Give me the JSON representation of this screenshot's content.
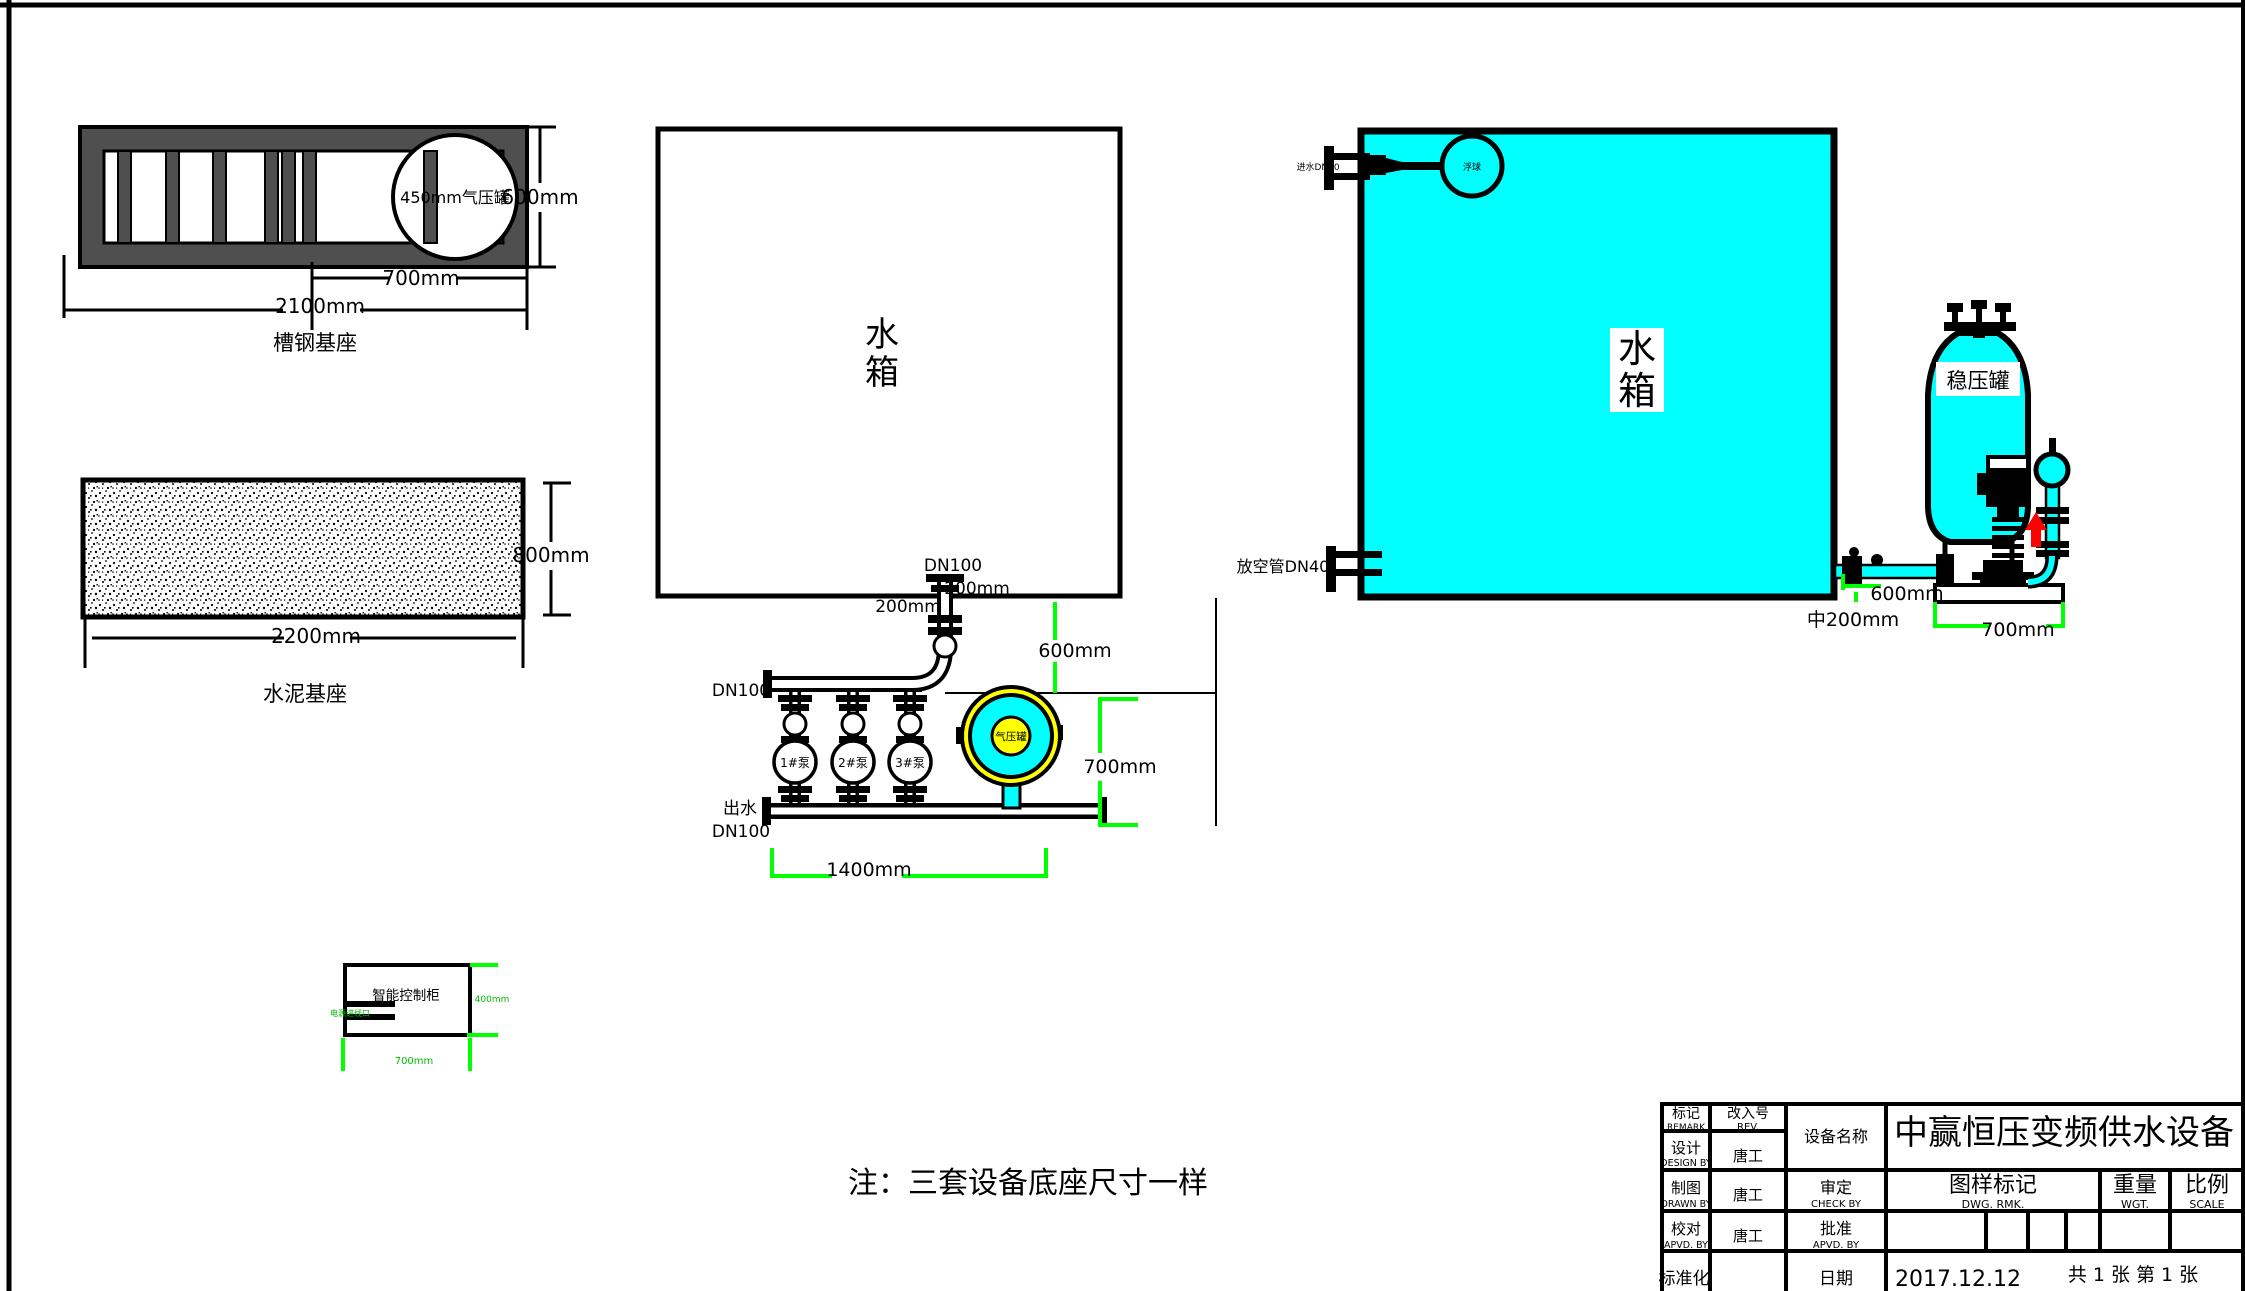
{
  "colors": {
    "cyan": "#00FFFF",
    "yellow": "#FFFF00",
    "dim_green": "#00FF00",
    "arrow_red": "#FF0000",
    "steel_gray": "#4F4F4F",
    "line_black": "#000000"
  },
  "steel_base": {
    "label": "槽钢基座",
    "tank_circle_label": "450mm气压罐",
    "dim_total_width": "2100mm",
    "dim_right_width": "700mm",
    "dim_height": "600mm"
  },
  "cement_base": {
    "label": "水泥基座",
    "dim_width": "2200mm",
    "dim_height": "800mm"
  },
  "plan_view": {
    "tank_char_top": "水",
    "tank_char_bottom": "箱",
    "inlet_dn": "DN100",
    "offset_right": "200mm",
    "offset_left": "200mm",
    "manifold_dn": "DN100",
    "outlet_label": "出水",
    "outlet_dn": "DN100",
    "pumps": [
      "1#泵",
      "2#泵",
      "3#泵"
    ],
    "pressure_tank_label": "气压罐",
    "dim_gap": "600mm",
    "dim_depth": "700mm",
    "dim_width": "1400mm"
  },
  "elevation_view": {
    "tank_char_top": "水",
    "tank_char_bottom": "箱",
    "inlet_label": "进水DN50",
    "float_label": "浮球",
    "drain_label": "放空管DN40",
    "stab_tank_label": "稳压罐",
    "dim_gap": "600mm",
    "dim_offset": "中200mm",
    "dim_base_width": "700mm"
  },
  "control_cabinet": {
    "label": "智能控制柜",
    "inlet_note": "电源进线口",
    "dim_height": "400mm",
    "dim_width": "700mm"
  },
  "note": "注：三套设备底座尺寸一样",
  "title_block": {
    "remark_cn": "标记",
    "remark_en": "REMARK",
    "rev_cn": "改入号",
    "rev_en": "REV.",
    "equip_name_label": "设备名称",
    "title": "中赢恒压变频供水设备",
    "design_cn": "设计",
    "design_en": "DESIGN BY",
    "design_val": "唐工",
    "draw_cn": "制图",
    "draw_en": "DRAWN BY",
    "draw_val": "唐工",
    "check_cn": "审定",
    "check_en": "CHECK BY",
    "proof_cn": "校对",
    "proof_en": "APVD. BY",
    "proof_val": "唐工",
    "approve_cn": "批准",
    "approve_en": "APVD. BY",
    "std_cn": "标准化",
    "date_cn": "日期",
    "date_val": "2017.12.12",
    "drg_cn": "图样标记",
    "drg_en": "DWG. RMK.",
    "wgt_cn": "重量",
    "wgt_en": "WGT.",
    "scale_cn": "比例",
    "scale_en": "SCALE",
    "sheet": "共 1  张    第 1  张"
  }
}
